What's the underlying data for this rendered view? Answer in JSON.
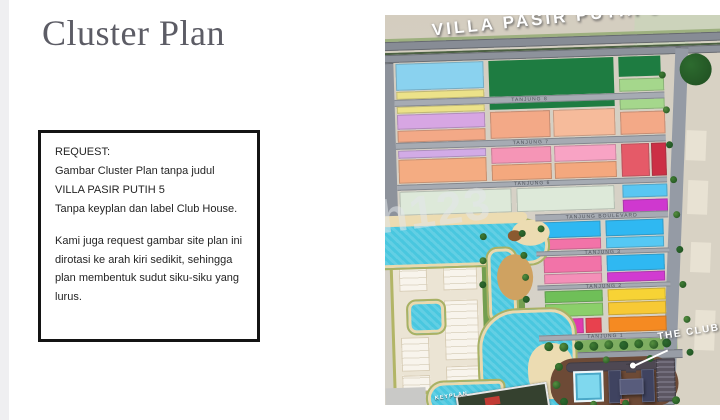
{
  "title": "Cluster Plan",
  "request_box": {
    "heading": "REQUEST:",
    "paragraph1": "Gambar Cluster Plan tanpa judul VILLA PASIR PUTIH 5",
    "paragraph2": "Tanpa keyplan dan label Club House.",
    "paragraph3": "Kami juga request gambar site plan ini dirotasi ke arah kiri sedikit, sehingga plan membentuk sudut siku-siku yang lurus."
  },
  "map": {
    "road_title": "VILLA PASIR PUTIH 5",
    "club_label": "THE CLUB HOUSE",
    "keyplan_label": "KEYPLAN",
    "watermark": "h123",
    "colors": {
      "water": "#49c7df",
      "sand": "#ecdcb2",
      "park_dark": "#1e7c41",
      "road": "#8d929b",
      "club_grounds": "#6d4a36",
      "building": "#3f4360"
    },
    "streets": [
      {
        "x": 13,
        "y": 80,
        "w": 270,
        "h": 7,
        "label": "TANJUNG 8"
      },
      {
        "x": 13,
        "y": 123,
        "w": 270,
        "h": 7,
        "label": "TANJUNG 7"
      },
      {
        "x": 13,
        "y": 165,
        "w": 270,
        "h": 6,
        "label": "TANJUNG 6"
      },
      {
        "x": 150,
        "y": 199,
        "w": 133,
        "h": 7,
        "label": "TANJUNG BOULEVARD"
      },
      {
        "x": 150,
        "y": 236,
        "w": 133,
        "h": 5,
        "label": "TANJUNG 3"
      },
      {
        "x": 150,
        "y": 270,
        "w": 133,
        "h": 5,
        "label": "TANJUNG 2"
      },
      {
        "x": 150,
        "y": 320,
        "w": 133,
        "h": 6,
        "label": "TANJUNG 1"
      }
    ],
    "layers": [
      {
        "cls": "flat",
        "name": "land-patch",
        "items": [
          {
            "x": 255,
            "y": -8,
            "w": 110,
            "h": 52,
            "c": "#ccd3bb",
            "rot": 4
          },
          {
            "x": 296,
            "y": 28,
            "w": 75,
            "h": 375,
            "c": "#d8d2c4",
            "rot": 4
          },
          {
            "x": 303,
            "y": 120,
            "w": 20,
            "h": 30,
            "c": "#e8e2d3",
            "rot": 4
          },
          {
            "x": 303,
            "y": 170,
            "w": 20,
            "h": 34,
            "c": "#e8e2d3",
            "rot": 4
          },
          {
            "x": 304,
            "y": 232,
            "w": 20,
            "h": 30,
            "c": "#e8e2d3",
            "rot": 4
          },
          {
            "x": 306,
            "y": 300,
            "w": 20,
            "h": 40,
            "c": "#e8e2d3",
            "rot": 4
          },
          {
            "x": -5,
            "y": 19,
            "w": 350,
            "h": 4,
            "c": "#9db07f"
          },
          {
            "x": -4,
            "y": 42,
            "w": 6,
            "h": 150,
            "c": "#8fae6e"
          }
        ]
      },
      {
        "cls": "fbase",
        "name": "faded-neighborhood",
        "items": [
          {
            "x": 3,
            "y": 225,
            "w": 95,
            "h": 150,
            "r": "14px 24px 4px 4px"
          }
        ]
      },
      {
        "cls": "fblock",
        "name": "faded-building",
        "items": [
          {
            "x": 12,
            "y": 238,
            "w": 28,
            "h": 34
          },
          {
            "x": 56,
            "y": 238,
            "w": 34,
            "h": 34
          },
          {
            "x": 12,
            "y": 318,
            "w": 28,
            "h": 34
          },
          {
            "x": 56,
            "y": 282,
            "w": 34,
            "h": 60
          },
          {
            "x": 12,
            "y": 356,
            "w": 28,
            "h": 16
          },
          {
            "x": 56,
            "y": 348,
            "w": 34,
            "h": 24
          }
        ]
      },
      {
        "cls": "flat",
        "name": "photo-corner",
        "items": [
          {
            "x": -5,
            "y": 368,
            "w": 40,
            "h": 26,
            "c": "#c9c9c7"
          }
        ]
      },
      {
        "cls": "flat",
        "name": "park",
        "items": [
          {
            "x": 108,
            "y": 44,
            "w": 125,
            "h": 36,
            "c": "#1e7c41"
          },
          {
            "x": 238,
            "y": 44,
            "w": 42,
            "h": 20,
            "c": "#1e7c41"
          },
          {
            "x": 108,
            "y": 84,
            "w": 125,
            "h": 9,
            "c": "#1e7c41"
          },
          {
            "x": 150,
            "y": 326,
            "w": 138,
            "h": 12,
            "c": "#7fae62"
          },
          {
            "x": 95,
            "y": 212,
            "w": 8,
            "h": 100,
            "c": "#739f50"
          },
          {
            "x": 129,
            "y": 212,
            "w": 8,
            "h": 98,
            "c": "#739f50"
          }
        ]
      },
      {
        "cls": "road",
        "name": "road",
        "items": [
          {
            "x": -5,
            "y": 22,
            "w": 350,
            "h": 9,
            "c": "#878c95"
          },
          {
            "x": -5,
            "y": 33,
            "w": 350,
            "h": 2,
            "c": "#5f7f50"
          },
          {
            "x": -5,
            "y": 35,
            "w": 350,
            "h": 8,
            "c": "#8d929b"
          },
          {
            "x": 0,
            "y": 43,
            "w": 13,
            "h": 157,
            "c": "#8d929b"
          },
          {
            "x": 283,
            "y": 36,
            "w": 13,
            "h": 358,
            "c": "#959ba5",
            "rot": 4
          },
          {
            "x": 148,
            "y": 338,
            "w": 145,
            "h": 9,
            "c": "#989da6"
          }
        ]
      },
      {
        "cls": "lots",
        "name": "housing-block",
        "items": [
          {
            "x": 15,
            "y": 44,
            "w": 88,
            "h": 27,
            "c": "#8ad2ef"
          },
          {
            "x": 15,
            "y": 72,
            "w": 88,
            "h": 8,
            "c": "#ece289"
          },
          {
            "x": 238,
            "y": 66,
            "w": 45,
            "h": 13,
            "c": "#a5d78c"
          },
          {
            "x": 15,
            "y": 87,
            "w": 88,
            "h": 7,
            "c": "#ece289"
          },
          {
            "x": 15,
            "y": 95,
            "w": 88,
            "h": 15,
            "c": "#d7a6e3"
          },
          {
            "x": 15,
            "y": 111,
            "w": 88,
            "h": 12,
            "c": "#f3a987"
          },
          {
            "x": 108,
            "y": 95,
            "w": 60,
            "h": 27,
            "c": "#f3a987"
          },
          {
            "x": 171,
            "y": 95,
            "w": 62,
            "h": 27,
            "c": "#f6bb9b"
          },
          {
            "x": 238,
            "y": 84,
            "w": 45,
            "h": 13,
            "c": "#a5d78c"
          },
          {
            "x": 238,
            "y": 99,
            "w": 45,
            "h": 23,
            "c": "#f3a987"
          },
          {
            "x": 15,
            "y": 131,
            "w": 88,
            "h": 8,
            "c": "#d2abe6"
          },
          {
            "x": 15,
            "y": 140,
            "w": 88,
            "h": 24,
            "c": "#f4ac82"
          },
          {
            "x": 108,
            "y": 131,
            "w": 60,
            "h": 16,
            "c": "#f595b6"
          },
          {
            "x": 171,
            "y": 131,
            "w": 62,
            "h": 16,
            "c": "#f8a3c4"
          },
          {
            "x": 108,
            "y": 148,
            "w": 60,
            "h": 16,
            "c": "#f4a87e"
          },
          {
            "x": 171,
            "y": 148,
            "w": 62,
            "h": 16,
            "c": "#f4a87e"
          },
          {
            "x": 238,
            "y": 131,
            "w": 28,
            "h": 33,
            "c": "#e55a68"
          },
          {
            "x": 268,
            "y": 131,
            "w": 15,
            "h": 33,
            "c": "#cc2f45"
          },
          {
            "x": 15,
            "y": 172,
            "w": 112,
            "h": 24,
            "c": "#dde9d9"
          },
          {
            "x": 132,
            "y": 172,
            "w": 98,
            "h": 24,
            "c": "#dde9d9"
          },
          {
            "x": 238,
            "y": 172,
            "w": 45,
            "h": 13,
            "c": "#59c6f2"
          },
          {
            "x": 238,
            "y": 187,
            "w": 45,
            "h": 13,
            "c": "#cf38cf"
          },
          {
            "x": 157,
            "y": 207,
            "w": 58,
            "h": 16,
            "c": "#2fb8f2"
          },
          {
            "x": 220,
            "y": 207,
            "w": 58,
            "h": 16,
            "c": "#2fb8f2"
          },
          {
            "x": 157,
            "y": 224,
            "w": 58,
            "h": 11,
            "c": "#f273a8"
          },
          {
            "x": 220,
            "y": 224,
            "w": 58,
            "h": 11,
            "c": "#55c8f4"
          },
          {
            "x": 157,
            "y": 242,
            "w": 58,
            "h": 16,
            "c": "#f273a8"
          },
          {
            "x": 220,
            "y": 242,
            "w": 58,
            "h": 16,
            "c": "#2fb8f2"
          },
          {
            "x": 157,
            "y": 259,
            "w": 58,
            "h": 10,
            "c": "#f48fb8"
          },
          {
            "x": 220,
            "y": 259,
            "w": 58,
            "h": 10,
            "c": "#d13bd1"
          },
          {
            "x": 157,
            "y": 276,
            "w": 58,
            "h": 12,
            "c": "#6fbf58"
          },
          {
            "x": 220,
            "y": 276,
            "w": 58,
            "h": 12,
            "c": "#f7d335"
          },
          {
            "x": 157,
            "y": 289,
            "w": 58,
            "h": 13,
            "c": "#8bcf6a"
          },
          {
            "x": 220,
            "y": 289,
            "w": 58,
            "h": 13,
            "c": "#f7c935"
          },
          {
            "x": 157,
            "y": 304,
            "w": 18,
            "h": 15,
            "c": "#9b3fd1"
          },
          {
            "x": 177,
            "y": 304,
            "w": 18,
            "h": 15,
            "c": "#e03bb0"
          },
          {
            "x": 197,
            "y": 304,
            "w": 16,
            "h": 15,
            "c": "#e8414e"
          },
          {
            "x": 220,
            "y": 304,
            "w": 58,
            "h": 15,
            "c": "#f58a22"
          }
        ]
      },
      {
        "cls": "water",
        "name": "lake",
        "items": [
          {
            "x": -8,
            "y": 202,
            "w": 172,
            "h": 48,
            "r": "0 36px 26px 0"
          },
          {
            "x": 99,
            "y": 230,
            "w": 32,
            "h": 78,
            "r": "12px"
          },
          {
            "x": 88,
            "y": 292,
            "w": 100,
            "h": 106,
            "r": "40px 26px 8px 40px"
          },
          {
            "x": 35,
            "y": 362,
            "w": 80,
            "h": 36,
            "r": "20px 8px 8px 20px"
          },
          {
            "x": 18,
            "y": 280,
            "w": 40,
            "h": 36,
            "r": "10px"
          }
        ]
      },
      {
        "cls": "sand",
        "name": "beach-sand",
        "items": [
          {
            "x": -8,
            "y": 196,
            "w": 150,
            "h": 10,
            "c": "#ecdcb2",
            "r": "8px"
          },
          {
            "x": 126,
            "y": 204,
            "w": 38,
            "h": 26,
            "c": "#ecdcb2",
            "r": "50%"
          },
          {
            "x": 110,
            "y": 238,
            "w": 36,
            "h": 46,
            "c": "#cfa261",
            "r": "50%"
          },
          {
            "x": 138,
            "y": 328,
            "w": 46,
            "h": 56,
            "c": "#ecdcb2",
            "r": "45%"
          },
          {
            "x": 122,
            "y": 214,
            "w": 14,
            "h": 11,
            "c": "#8a5a30",
            "r": "50%"
          },
          {
            "x": 130,
            "y": 372,
            "w": 12,
            "h": 11,
            "c": "#7a4f28",
            "r": "50%"
          }
        ]
      },
      {
        "cls": "flat",
        "name": "club-grounds",
        "items": [
          {
            "x": 160,
            "y": 344,
            "w": 128,
            "h": 50,
            "c": "#6d4a36",
            "r": "26px 30px 24px 22px"
          }
        ]
      },
      {
        "cls": "road",
        "name": "club-driveway",
        "items": [
          {
            "x": 176,
            "y": 348,
            "w": 102,
            "h": 10,
            "c": "#4e4853",
            "r": "6px"
          },
          {
            "x": 236,
            "y": 351,
            "w": 10,
            "h": 9,
            "c": "#4e4853"
          }
        ]
      },
      {
        "cls": "pool",
        "name": "club-pool",
        "items": [
          {
            "x": 183,
            "y": 357,
            "w": 30,
            "h": 31
          }
        ]
      },
      {
        "cls": "bldg",
        "name": "club-building",
        "items": [
          {
            "x": 218,
            "y": 357,
            "w": 13,
            "h": 33,
            "c": "#3f4360"
          },
          {
            "x": 251,
            "y": 357,
            "w": 13,
            "h": 33,
            "c": "#3f4360"
          },
          {
            "x": 229,
            "y": 366,
            "w": 24,
            "h": 16,
            "c": "#585c7c"
          },
          {
            "x": 229,
            "y": 386,
            "w": 9,
            "h": 5,
            "c": "#a85544"
          }
        ]
      },
      {
        "cls": "parking",
        "name": "parking-lot",
        "items": [
          {
            "x": 266,
            "y": 347,
            "w": 19,
            "h": 43
          }
        ]
      },
      {
        "cls": "inset",
        "name": "keyplan-inset",
        "items": [
          {
            "x": 66,
            "y": 372,
            "w": 88,
            "h": 24,
            "c": "#35412f",
            "rot": -7
          }
        ]
      },
      {
        "cls": "flat",
        "name": "keyplan-highlight",
        "items": [
          {
            "x": 94,
            "y": 380,
            "w": 15,
            "h": 8,
            "c": "#c23b34",
            "rot": -7
          }
        ]
      }
    ],
    "tree_colors": [
      "#2d6b2f",
      "#3f7d33",
      "#55903f"
    ],
    "trees": [
      [
        299,
        43,
        32
      ],
      [
        278,
        60,
        7
      ],
      [
        281,
        95,
        7
      ],
      [
        283,
        130,
        7
      ],
      [
        286,
        165,
        7
      ],
      [
        288,
        200,
        7
      ],
      [
        290,
        235,
        7
      ],
      [
        292,
        270,
        7
      ],
      [
        295,
        305,
        7
      ],
      [
        297,
        338,
        7
      ],
      [
        155,
        327,
        9
      ],
      [
        170,
        328,
        9
      ],
      [
        185,
        327,
        9
      ],
      [
        200,
        328,
        9
      ],
      [
        215,
        327,
        9
      ],
      [
        230,
        328,
        9
      ],
      [
        245,
        327,
        9
      ],
      [
        260,
        328,
        9
      ],
      [
        273,
        327,
        9
      ],
      [
        165,
        348,
        8
      ],
      [
        162,
        366,
        8
      ],
      [
        169,
        383,
        8
      ],
      [
        281,
        385,
        8
      ],
      [
        213,
        343,
        7
      ],
      [
        257,
        343,
        7
      ],
      [
        231,
        387,
        7
      ],
      [
        199,
        387,
        7
      ],
      [
        133,
        214,
        7
      ],
      [
        134,
        236,
        7
      ],
      [
        135,
        258,
        7
      ],
      [
        135,
        280,
        7
      ],
      [
        94,
        216,
        7
      ],
      [
        93,
        240,
        7
      ],
      [
        92,
        264,
        7
      ],
      [
        152,
        210,
        7
      ]
    ]
  }
}
